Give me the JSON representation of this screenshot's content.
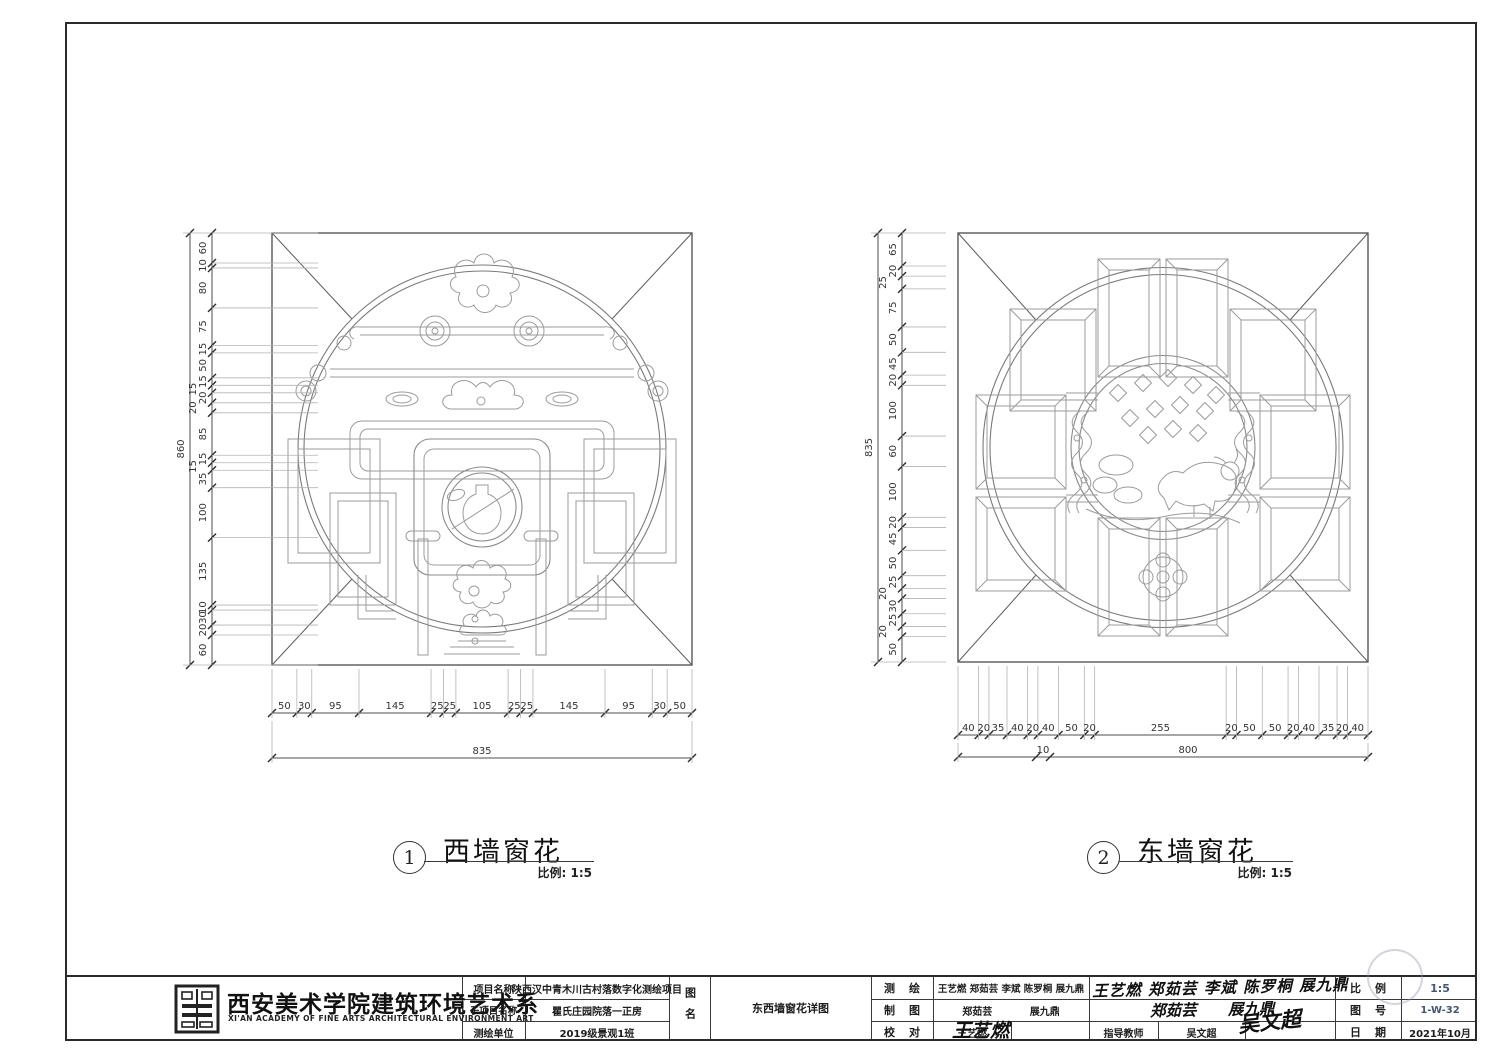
{
  "drawings": [
    {
      "number": "1",
      "title": "西墙窗花",
      "scale_label": "比例: 1:5",
      "height_total": "860",
      "v_dims": [
        "60",
        "10",
        "80",
        "75",
        "15",
        "50",
        "15",
        "15",
        "20",
        "20",
        "85",
        "15",
        "15",
        "35",
        "100",
        "135",
        "10",
        "30",
        "20",
        "60"
      ],
      "width_total": "835",
      "h_dims": [
        "50",
        "30",
        "95",
        "145",
        "25",
        "25",
        "105",
        "25",
        "25",
        "145",
        "95",
        "30",
        "50"
      ]
    },
    {
      "number": "2",
      "title": "东墙窗花",
      "scale_label": "比例: 1:5",
      "height_total": "835",
      "v_dims": [
        "65",
        "20",
        "25",
        "75",
        "50",
        "45",
        "20",
        "100",
        "60",
        "100",
        "20",
        "45",
        "50",
        "25",
        "20",
        "30",
        "25",
        "20",
        "50"
      ],
      "width_total": "800",
      "width_extra": "10",
      "h_dims": [
        "40",
        "20",
        "35",
        "40",
        "20",
        "40",
        "50",
        "20",
        "255",
        "20",
        "50",
        "50",
        "20",
        "40",
        "35",
        "20",
        "40"
      ]
    }
  ],
  "titleblock": {
    "org_cn": "西安美术学院建筑环境艺术系",
    "org_en": "XI'AN ACADEMY OF FINE ARTS ARCHITECTURAL ENVIRONMENT ART",
    "project_label": "项目名称",
    "project_value": "陕西汉中青木川古村落数字化测绘项目",
    "subproject_label": "子项目名称",
    "subproject_value": "瞿氏庄园院落一正房",
    "unit_label": "测绘单位",
    "unit_value": "2019级景观1班",
    "sheetname_label": "图名",
    "sheetname_value": "东西墙窗花详图",
    "survey_label": "测绘",
    "survey_value": "王艺燃 郑茹芸 李斌 陈罗桐 展九鼎",
    "draft_label": "制图",
    "draft_value": "郑茹芸 展九鼎",
    "check_label": "校对",
    "check_value": "王艺燃",
    "advisor_label": "指导教师",
    "advisor_value": "吴文超",
    "scale_label": "比例",
    "scale_value": "1:5",
    "sheetno_label": "图号",
    "sheetno_value": "1-W-32",
    "date_label": "日期",
    "date_value": "2021年10月",
    "signatures": {
      "survey": "王艺燃 郑茹芸 李斌 陈罗桐 展九鼎",
      "draft": "郑茹芸  展九鼎",
      "check": "王艺燃",
      "advisor": "吴文超"
    }
  },
  "colors": {
    "line": "#4a4a4a",
    "ornament": "#9b9b9b",
    "accent_blue": "#41567a"
  }
}
